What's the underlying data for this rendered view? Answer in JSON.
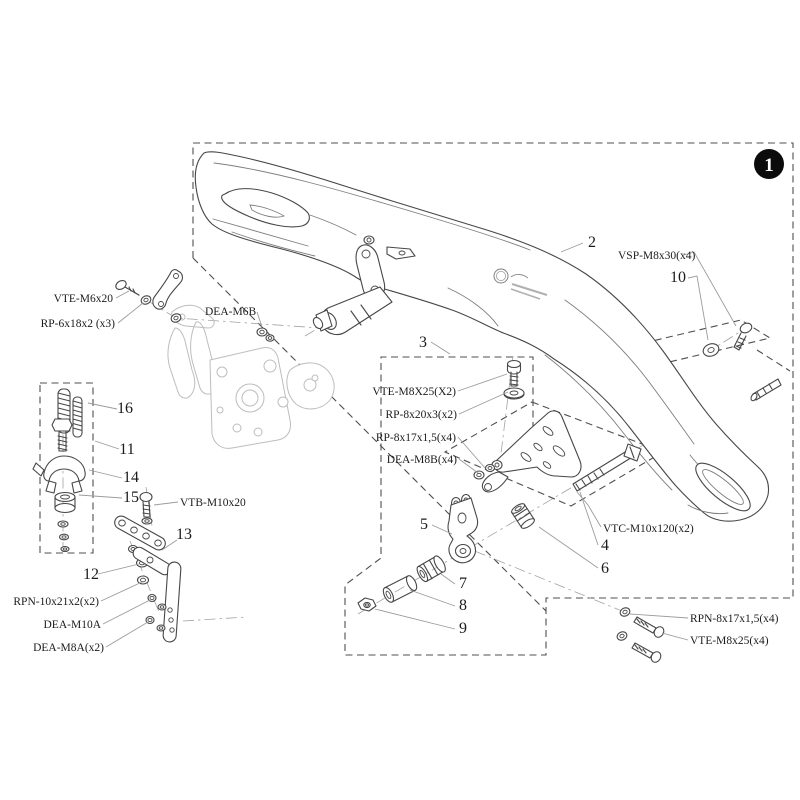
{
  "figure": {
    "badge": {
      "number": "1"
    },
    "part_numbers": {
      "n2": "2",
      "n3": "3",
      "n4": "4",
      "n5": "5",
      "n6": "6",
      "n7": "7",
      "n8": "8",
      "n9": "9",
      "n10": "10",
      "n11": "11",
      "n12": "12",
      "n13": "13",
      "n14": "14",
      "n15": "15",
      "n16": "16"
    },
    "hardware_labels": {
      "vte_m6x20": "VTE-M6x20",
      "rp_6x18x2": "RP-6x18x2 (x3)",
      "dea_m6b": "DEA-M6B",
      "vsp_m8x30": "VSP-M8x30(x4)",
      "vte_m8x25_kit": "VTE-M8X25(X2)",
      "rp_8x20x3": "RP-8x20x3(x2)",
      "rp_8x17x15_kit": "RP-8x17x1,5(x4)",
      "dea_m8b": "DEA-M8B(x4)",
      "vtc_m10x120": "VTC-M10x120(x2)",
      "vtb_m10x20": "VTB-M10x20",
      "rpn_10x21x2": "RPN-10x21x2(x2)",
      "dea_m10a": "DEA-M10A",
      "dea_m8a": "DEA-M8A(x2)",
      "rpn_8x17x15": "RPN-8x17x1,5(x4)",
      "vte_m8x25": "VTE-M8x25(x4)"
    },
    "colors": {
      "line": "#474747",
      "light_part": "#bdbdbd",
      "leader": "#9c9c9c",
      "dashed_border": "#4f4f4f",
      "badge_bg": "#0b0b0b",
      "badge_text": "#ffffff",
      "background": "#ffffff"
    }
  }
}
